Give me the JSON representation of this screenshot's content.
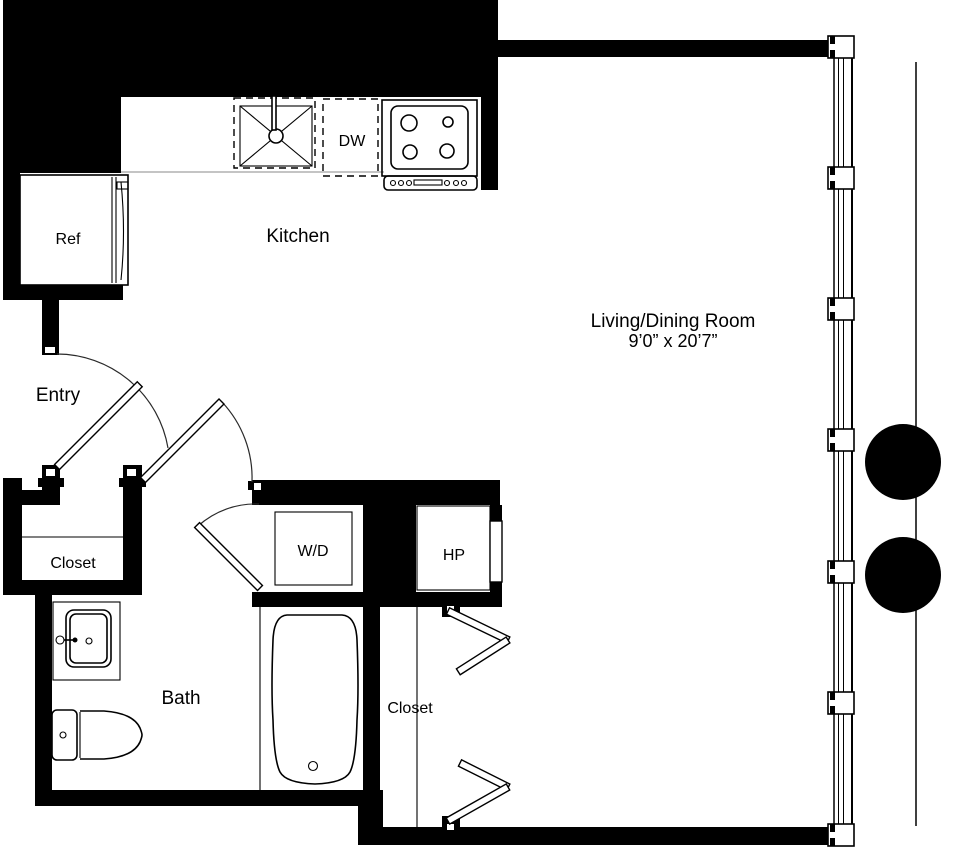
{
  "floor_plan": {
    "rooms": {
      "kitchen": {
        "label": "Kitchen"
      },
      "living_dining": {
        "label": "Living/Dining Room",
        "dimensions": "9’0” x 20’7”"
      },
      "entry": {
        "label": "Entry"
      },
      "bath": {
        "label": "Bath"
      },
      "entry_closet": {
        "label": "Closet"
      },
      "living_closet": {
        "label": "Closet"
      }
    },
    "fixtures": {
      "refrigerator": {
        "label": "Ref"
      },
      "dishwasher": {
        "label": "DW"
      },
      "washer_dryer": {
        "label": "W/D"
      },
      "heat_pump": {
        "label": "HP"
      }
    },
    "colors": {
      "wall": "#000000",
      "background": "#ffffff",
      "counter_line": "#8a8a8a"
    }
  }
}
